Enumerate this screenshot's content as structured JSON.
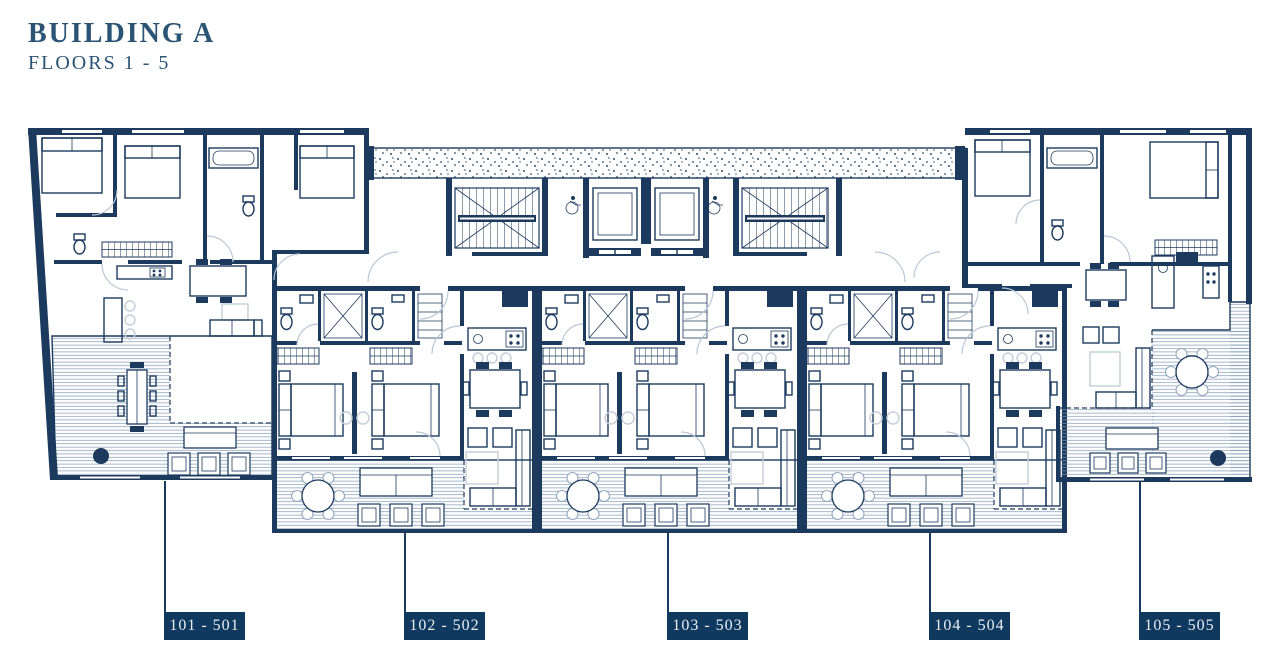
{
  "header": {
    "title": "BUILDING A",
    "subtitle": "FLOORS 1 - 5"
  },
  "plan": {
    "building": "A",
    "units": [
      {
        "label": "101 - 501"
      },
      {
        "label": "102 - 502"
      },
      {
        "label": "103 - 503"
      },
      {
        "label": "104 - 504"
      },
      {
        "label": "105 - 505"
      }
    ]
  },
  "icons": {
    "stairs": "stairs-icon",
    "elevator": "elevator-icon",
    "wheelchair": "wheelchair-icon",
    "bed": "bed-icon",
    "bathtub": "bathtub-icon",
    "toilet": "toilet-icon",
    "dining-table": "dining-table-icon",
    "round-table": "round-table-icon",
    "sofa": "sofa-icon",
    "planter": "planter-dot-icon"
  },
  "colors": {
    "ink": "#1c3a5e",
    "title_text": "#2b5374",
    "label_bg": "#10395f",
    "label_text": "#e9eef3",
    "door_arc": "#b9c7d6",
    "hatch_line": "#7d97b2"
  }
}
